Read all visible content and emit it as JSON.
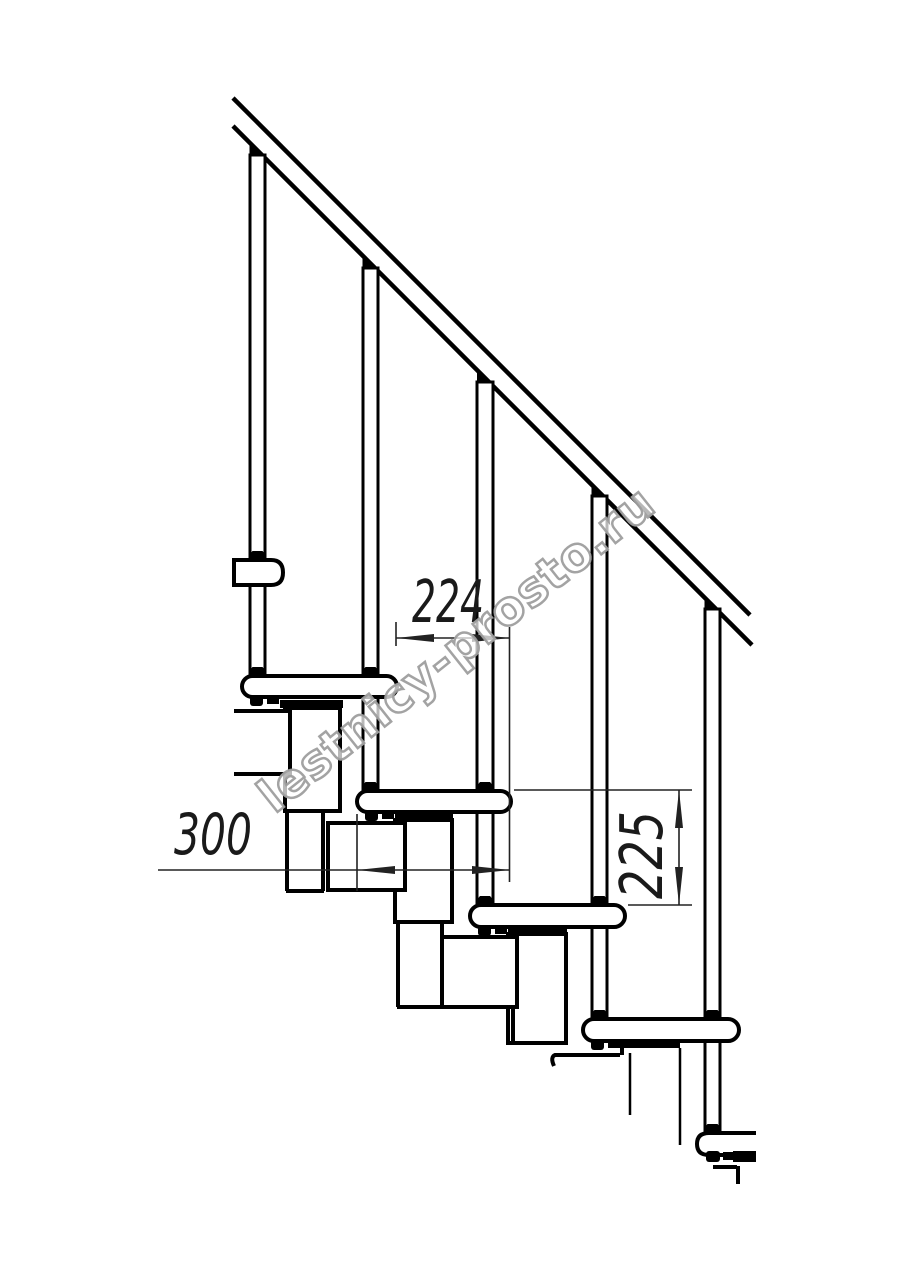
{
  "drawing": {
    "title": "staircase-side-view-technical-drawing",
    "dimensions": {
      "dim_top": "224",
      "dim_left": "300",
      "dim_right": "225"
    },
    "watermark": "lestnicy-prosto.ru",
    "colors": {
      "line": "#000000",
      "dimension_line": "#222222",
      "dimension_text": "#1a1a1a",
      "watermark": "#9e9e9e",
      "background": "#ffffff"
    }
  }
}
